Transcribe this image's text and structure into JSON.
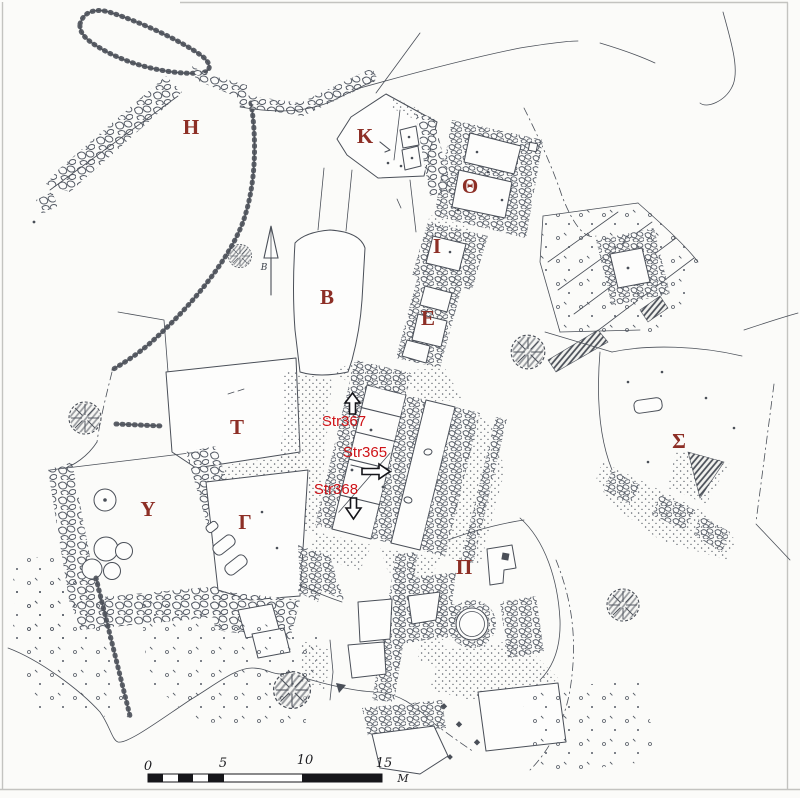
{
  "figure": {
    "kind": "Archaeological excavation site plan (scanned line drawing)",
    "note": "Hand-drawn stone-by-stone plan with Greek letter area designations, three annotated structures, north arrow and metric scale bar"
  },
  "colors": {
    "paper": "#fbfbf9",
    "ink": "#4a4f58",
    "area_label": "#8d2f26",
    "annotation_red": "#cf1318",
    "scale_black": "#16161a"
  },
  "area_labels": [
    {
      "id": "eta",
      "char": "H"
    },
    {
      "id": "kappa",
      "char": "K"
    },
    {
      "id": "theta",
      "char": "Θ"
    },
    {
      "id": "iota",
      "char": "I"
    },
    {
      "id": "beta",
      "char": "B"
    },
    {
      "id": "epsilon",
      "char": "E"
    },
    {
      "id": "tau",
      "char": "T"
    },
    {
      "id": "sigma",
      "char": "Σ"
    },
    {
      "id": "upsilon",
      "char": "Y"
    },
    {
      "id": "gamma",
      "char": "Γ"
    },
    {
      "id": "pi",
      "char": "Π"
    }
  ],
  "structure_annotations": [
    {
      "label": "Str367",
      "arrow_direction": "up"
    },
    {
      "label": "Str365",
      "arrow_direction": "right"
    },
    {
      "label": "Str368",
      "arrow_direction": "down"
    }
  ],
  "north_arrow": {
    "label": "B"
  },
  "scale_bar": {
    "tick_labels": [
      "0",
      "5",
      "10",
      "15"
    ],
    "unit_label": "M"
  }
}
